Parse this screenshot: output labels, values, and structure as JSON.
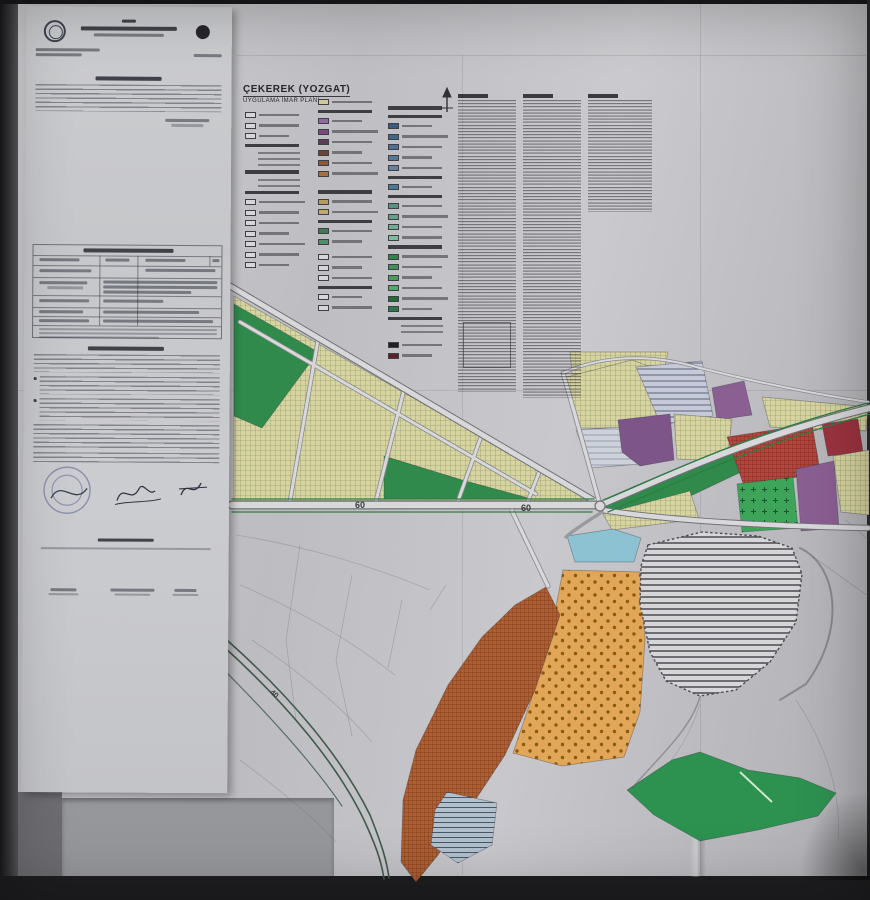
{
  "photo": {
    "background": "#242426"
  },
  "map_sheet": {
    "title": "ÇEKEREK (YOZGAT)",
    "subtitle": "UYGULAMA İMAR PLANI",
    "road_labels": [
      "60",
      "60",
      "40"
    ],
    "colors": {
      "paper": "#c7c7cb",
      "doc_paper": "#c9cacd",
      "residential_hatch_bg": "#d8d4a2",
      "residential_hatch_line": "#92a06a",
      "park_green": "#2f8a4b",
      "bright_green": "#3ea45a",
      "bright_green_mark": "#16592e",
      "forest_green": "#2d9150",
      "orange_bg": "#e2a658",
      "orange_dot": "#8a5a10",
      "brown_bg": "#ad5f33",
      "brown_line": "#7c3a18",
      "red_bg": "#b2453c",
      "red_line": "#7e2822",
      "dark_red": "#9c3340",
      "purple": "#8a5f92",
      "purple_dark": "#7d5588",
      "pond_blue": "#8cc2d2",
      "blue_stripe_bg": "#b2c0cc",
      "blue_stripe_line": "#44586a",
      "gray_stripe_bg": "#c6cad8",
      "gray_stripe_line": "#5c6478",
      "pale_stripe_bg": "#cdd1da",
      "pale_stripe_line": "#8a90a2",
      "blob_bg": "#d6d6d8",
      "blob_line": "#4a4a50",
      "road_fill": "#d8d8da",
      "road_casing": "#707076",
      "road_green_edge": "#2e7d45"
    },
    "legend": {
      "col1": [
        "B",
        "B",
        "B",
        "H",
        "L",
        "L",
        "L",
        "H",
        "L",
        "L",
        "H",
        "B",
        "B",
        "B",
        "B",
        "B",
        "B",
        "B"
      ],
      "col2": [
        "#cdc998",
        "H",
        "#8e6a9e",
        "#7a4a78",
        "#5e3a56",
        "#6e4438",
        "#8a5a3c",
        "#a4703c",
        "G",
        "H",
        "#b89a5a",
        "#c0aa6a",
        "H",
        "#3e7a52",
        "#4e8e6a",
        "G",
        "B",
        "B",
        "B",
        "H",
        "B",
        "B"
      ],
      "col3": [
        "H",
        "H",
        "#3a5a80",
        "#44648a",
        "#4e6e94",
        "#587898",
        "#62829e",
        "H",
        "#4a7a96",
        "H",
        "#56927e",
        "#62a088",
        "#6eae92",
        "#7abc9c",
        "H",
        "#2e8648",
        "#389252",
        "#42a05c",
        "#4cae66",
        "#1e6e38",
        "#28784a",
        "H",
        "L",
        "L",
        "G",
        "#202022",
        "#5c2026"
      ]
    }
  }
}
